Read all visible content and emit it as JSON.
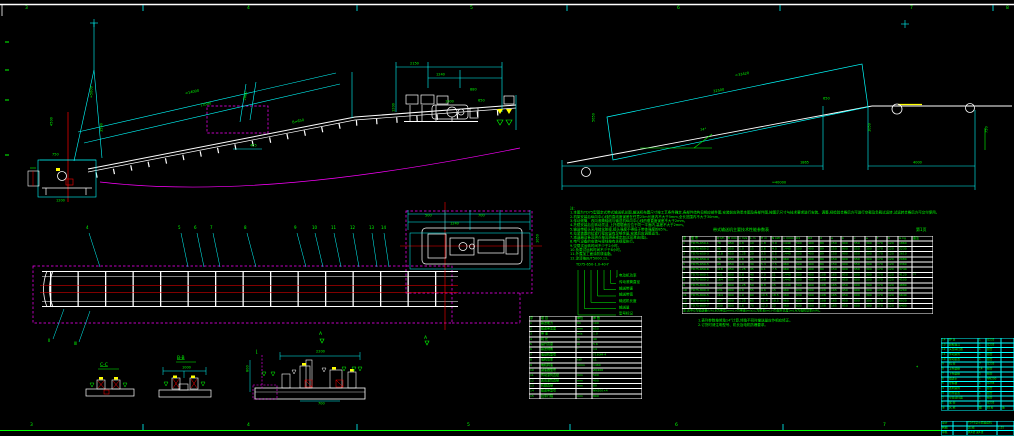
{
  "colors": {
    "cyan": "#00ffff",
    "green": "#00ff00",
    "magenta": "#ff00ff",
    "red": "#ff0000",
    "yellow": "#ffff00",
    "white": "#ffffff",
    "background": "#000000"
  },
  "border": {
    "top_zones": [
      {
        "x": 25,
        "t": "3"
      },
      {
        "x": 247,
        "t": "4"
      },
      {
        "x": 470,
        "t": "5"
      },
      {
        "x": 677,
        "t": "6"
      },
      {
        "x": 910,
        "t": "7"
      },
      {
        "x": 1006,
        "t": "8"
      }
    ],
    "bottom_zones": [
      {
        "x": 30,
        "t": "3"
      },
      {
        "x": 247,
        "t": "4"
      },
      {
        "x": 467,
        "t": "5"
      },
      {
        "x": 675,
        "t": "6"
      },
      {
        "x": 883,
        "t": "7"
      }
    ]
  },
  "notes": {
    "lines": [
      "注:",
      "1.本图为TD75型固定式带式输送机总图,输送机布置尺寸按工艺条件确定,各部件结构见相应部件图,安装前应熟悉本图及各部件图,按图示尺寸与技术要求进行安装、调整,经检验合格后方可进行空载及负载试运转,试运转合格后方可交付使用。",
      "2.机架安装后纵向中心线的直线度误差在任意25m长度内不大于5mm,全长范围内不大于30mm。",
      "3.传动滚筒、改向滚筒轴线与输送机纵向中心线的垂直度误差不大于2mm。",
      "4.托辊安装后应转动灵活,上托辊辊面应位于同一平面内,高差不大于2mm。",
      "5.输送带接头采用硫化胶接,接头强度不得低于带体强度的85%。",
      "6.拉紧装置的拉紧行程应留有足够余量,安装后应调整适当。",
      "7.减速器及各润滑点按润滑表规定加注润滑油(脂)。",
      "8.电气设备的安装与接线按有关规程执行。",
      "9.空载试运转时间不少于2小时。",
      "10.负载试运转时间不少于8小时。",
      "11.外露加工面涂防锈油脂。",
      "12.涂漆按JB/T5000.12。"
    ]
  },
  "type_key": {
    "code": "TD75-650-1.0-40-Y",
    "labels": [
      "电动机功率",
      "传动滚筒直径",
      "输送带速",
      "输送带宽",
      "输送机长度",
      "输送量",
      "型号标记"
    ]
  },
  "annotations": {
    "dims": [
      {
        "x": 185,
        "y": 92,
        "r": -12,
        "t": "≈14000"
      },
      {
        "x": 200,
        "y": 104,
        "r": -12,
        "t": "13500"
      },
      {
        "x": 292,
        "y": 121,
        "r": -12,
        "t": "B=650"
      },
      {
        "x": 90,
        "y": 98,
        "r": -90,
        "t": "≈5000"
      },
      {
        "x": 50,
        "y": 126,
        "r": -90,
        "t": "4500"
      },
      {
        "x": 100,
        "y": 132,
        "r": -90,
        "t": "3500"
      },
      {
        "x": 243,
        "y": 100,
        "r": -78,
        "t": "2860"
      },
      {
        "x": 250,
        "y": 144,
        "r": 0,
        "t": "455"
      },
      {
        "x": 56,
        "y": 199,
        "r": 0,
        "t": "1200"
      },
      {
        "x": 52,
        "y": 153,
        "r": 0,
        "t": "750"
      },
      {
        "x": 410,
        "y": 62,
        "r": 0,
        "t": "2150"
      },
      {
        "x": 436,
        "y": 73,
        "r": 0,
        "t": "1240"
      },
      {
        "x": 470,
        "y": 88,
        "r": 0,
        "t": "880"
      },
      {
        "x": 392,
        "y": 112,
        "r": -90,
        "t": "1200"
      },
      {
        "x": 478,
        "y": 99,
        "r": 0,
        "t": "650"
      },
      {
        "x": 735,
        "y": 74,
        "r": -10,
        "t": "≈33420"
      },
      {
        "x": 713,
        "y": 90,
        "r": -10,
        "t": "32500"
      },
      {
        "x": 592,
        "y": 122,
        "r": -90,
        "t": "5650"
      },
      {
        "x": 868,
        "y": 132,
        "r": -90,
        "t": "1050"
      },
      {
        "x": 800,
        "y": 161,
        "r": 0,
        "t": "1865"
      },
      {
        "x": 913,
        "y": 161,
        "r": 0,
        "t": "4000"
      },
      {
        "x": 772,
        "y": 181,
        "r": 0,
        "t": "≈40000"
      },
      {
        "x": 700,
        "y": 128,
        "r": 0,
        "t": "14°"
      },
      {
        "x": 823,
        "y": 97,
        "r": 0,
        "t": "650"
      },
      {
        "x": 985,
        "y": 133,
        "r": -90,
        "t": "750"
      },
      {
        "x": 425,
        "y": 214,
        "r": 0,
        "t": "500"
      },
      {
        "x": 478,
        "y": 214,
        "r": 0,
        "t": "700"
      },
      {
        "x": 450,
        "y": 222,
        "r": 0,
        "t": "1240"
      },
      {
        "x": 536,
        "y": 243,
        "r": -90,
        "t": "1050"
      },
      {
        "x": 182,
        "y": 366,
        "r": 0,
        "t": "1000"
      },
      {
        "x": 316,
        "y": 350,
        "r": 0,
        "t": "2200"
      },
      {
        "x": 246,
        "y": 372,
        "r": -90,
        "t": "800"
      },
      {
        "x": 318,
        "y": 402,
        "r": 0,
        "t": "700"
      },
      {
        "x": 445,
        "y": 100,
        "r": 0,
        "t": "1000"
      }
    ],
    "labels": [
      {
        "x": 100,
        "y": 363,
        "t": "C-C",
        "u": 1
      },
      {
        "x": 177,
        "y": 356,
        "t": "B-B",
        "u": 1
      },
      {
        "x": 256,
        "y": 350,
        "t": "Ⅰ",
        "u": 1
      },
      {
        "x": 319,
        "y": 332,
        "t": "A",
        "u": 0
      },
      {
        "x": 424,
        "y": 336,
        "t": "A",
        "u": 0
      },
      {
        "x": 916,
        "y": 366,
        "t": "*",
        "u": 0
      }
    ]
  },
  "callouts": {
    "plan_top": [
      {
        "x": 88,
        "dx": 12,
        "t": "4"
      },
      {
        "x": 180,
        "dx": 8,
        "t": "5"
      },
      {
        "x": 196,
        "dx": 8,
        "t": "6"
      },
      {
        "x": 212,
        "dx": 8,
        "t": "7"
      },
      {
        "x": 246,
        "dx": 10,
        "t": "8"
      },
      {
        "x": 296,
        "dx": 10,
        "t": "9"
      },
      {
        "x": 314,
        "dx": 9,
        "t": "10"
      },
      {
        "x": 333,
        "dx": 8,
        "t": "11"
      },
      {
        "x": 352,
        "dx": 7,
        "t": "12"
      },
      {
        "x": 371,
        "dx": 6,
        "t": "13"
      },
      {
        "x": 383,
        "dx": 6,
        "t": "14"
      }
    ],
    "plan_bottom": [
      {
        "x": 50,
        "y": 341,
        "tx": 64,
        "ty": 309,
        "t": "Ⅱ"
      },
      {
        "x": 76,
        "y": 344,
        "tx": 90,
        "ty": 311,
        "t": "Ⅲ"
      }
    ]
  },
  "big_table": {
    "title": "带式输送机主要技术性能参数表",
    "page": "第1页",
    "headers": [
      "序",
      "型  号",
      "Q t/h",
      "B mm",
      "v m/s",
      "L m",
      "H m",
      "N kW",
      "n r/min",
      "D1",
      "D2",
      "d",
      "a",
      "b",
      "c",
      "e",
      "f",
      "h",
      "G kg",
      "备注"
    ],
    "rows": [
      [
        "1",
        "TD75-650-1",
        "78",
        "650",
        "0.8",
        "10",
        "1.8",
        "3.0",
        "1440",
        "500",
        "400",
        "89",
        "150",
        "900",
        "550",
        "300",
        "170",
        "120",
        "1860",
        ""
      ],
      [
        "2",
        "TD75-650-2",
        "98",
        "650",
        "1.0",
        "15",
        "2.6",
        "4.0",
        "1440",
        "500",
        "400",
        "89",
        "150",
        "900",
        "550",
        "300",
        "170",
        "120",
        "2230",
        ""
      ],
      [
        "3",
        "TD75-650-3",
        "118",
        "650",
        "1.25",
        "20",
        "3.5",
        "5.5",
        "1440",
        "500",
        "400",
        "89",
        "150",
        "900",
        "550",
        "300",
        "170",
        "120",
        "2610",
        ""
      ],
      [
        "4",
        "TD75-650-4",
        "78",
        "650",
        "0.8",
        "25",
        "4.4",
        "5.5",
        "960",
        "500",
        "400",
        "89",
        "150",
        "900",
        "550",
        "300",
        "170",
        "120",
        "2980",
        ""
      ],
      [
        "5",
        "TD75-650-5",
        "98",
        "650",
        "1.0",
        "30",
        "5.3",
        "7.5",
        "960",
        "500",
        "400",
        "89",
        "150",
        "900",
        "550",
        "300",
        "170",
        "120",
        "3360",
        ""
      ],
      [
        "6",
        "TD75-650-6",
        "118",
        "650",
        "1.25",
        "35",
        "6.1",
        "7.5",
        "960",
        "500",
        "400",
        "89",
        "150",
        "900",
        "550",
        "300",
        "170",
        "120",
        "3740",
        ""
      ],
      [
        "7",
        "TD75-800-1",
        "131",
        "800",
        "0.8",
        "40",
        "7.0",
        "11",
        "1440",
        "500",
        "400",
        "108",
        "165",
        "950",
        "600",
        "300",
        "170",
        "120",
        "4120",
        "**"
      ],
      [
        "8",
        "TD75-800-2",
        "164",
        "800",
        "1.0",
        "45",
        "7.9",
        "11",
        "1440",
        "500",
        "400",
        "108",
        "165",
        "950",
        "600",
        "300",
        "170",
        "120",
        "4500",
        ""
      ],
      [
        "9",
        "TD75-800-3",
        "197",
        "800",
        "1.25",
        "50",
        "8.8",
        "15",
        "1440",
        "500",
        "400",
        "108",
        "165",
        "950",
        "600",
        "300",
        "170",
        "120",
        "4880",
        ""
      ],
      [
        "10",
        "TD75-800-4",
        "131",
        "800",
        "0.8",
        "55",
        "9.6",
        "15",
        "960",
        "630",
        "500",
        "108",
        "165",
        "950",
        "600",
        "300",
        "170",
        "120",
        "5260",
        ""
      ],
      [
        "11",
        "TD75-800-5",
        "164",
        "800",
        "1.0",
        "60",
        "10.5",
        "18.5",
        "960",
        "630",
        "500",
        "108",
        "165",
        "950",
        "600",
        "300",
        "170",
        "120",
        "5640",
        ""
      ],
      [
        "12",
        "TD75-800-6",
        "197",
        "800",
        "1.25",
        "65",
        "11.4",
        "18.5",
        "960",
        "630",
        "500",
        "108",
        "165",
        "950",
        "600",
        "300",
        "170",
        "120",
        "6020",
        ""
      ],
      [
        "13",
        "TD75-800-7",
        "230",
        "800",
        "1.6",
        "70",
        "12.3",
        "22",
        "960",
        "630",
        "500",
        "108",
        "165",
        "950",
        "600",
        "300",
        "170",
        "120",
        "6400",
        ""
      ]
    ],
    "footnote": "注:表中Q为输送量(t/h),B为带宽(mm),v为带速(m/s),L为机长(m),H为提升高度(m),N为电机功率(kW)。",
    "under_notes": [
      "1.表列参数按倾角14°计算,倾角不同时输送量应作相应修正。",
      "2.订货时请注明型号、机长及电机防爆要求。"
    ]
  },
  "spec_table": {
    "headers": [
      "序",
      "项  目",
      "单位",
      "参  数"
    ],
    "rows": [
      [
        "1",
        "输送能力",
        "t/h",
        "100"
      ],
      [
        "2",
        "输送带宽度",
        "mm",
        "650"
      ],
      [
        "3",
        "带  速",
        "m/s",
        "1.0"
      ],
      [
        "4",
        "机  长",
        "m",
        "40"
      ],
      [
        "5",
        "提升高度",
        "m",
        "5.6"
      ],
      [
        "6",
        "输送倾角",
        "°",
        "14"
      ],
      [
        "7",
        "电动机型号",
        "",
        "Y160M-4"
      ],
      [
        "8",
        "电机功率",
        "kW",
        "11"
      ],
      [
        "9",
        "电机转速",
        "r/min",
        "1460"
      ],
      [
        "10",
        "减速器型号",
        "",
        "ZQ400"
      ],
      [
        "11",
        "传动滚筒直径",
        "mm",
        "500"
      ],
      [
        "12",
        "改向滚筒直径",
        "mm",
        "400"
      ],
      [
        "13",
        "托辊直径",
        "mm",
        "89"
      ],
      [
        "14",
        "输送带型号",
        "",
        "NN200×4"
      ],
      [
        "15",
        "拉紧行程",
        "mm",
        "800"
      ]
    ]
  },
  "parts_list": {
    "rows": [
      [
        "14",
        "护  罩",
        "1",
        "Q235",
        ""
      ],
      [
        "13",
        "卸料漏斗",
        "1",
        "Q235",
        ""
      ],
      [
        "12",
        "头部清扫器",
        "1",
        "组合",
        ""
      ],
      [
        "11",
        "传动滚筒",
        "1",
        "组合",
        ""
      ],
      [
        "10",
        "驱动装置",
        "1",
        "组合",
        ""
      ],
      [
        "9",
        "机  架",
        "7",
        "Q235",
        ""
      ],
      [
        "8",
        "上托辊组",
        "14",
        "组合",
        ""
      ],
      [
        "7",
        "下托辊组",
        "5",
        "组合",
        ""
      ],
      [
        "6",
        "输送带",
        "1",
        "NN200",
        ""
      ],
      [
        "5",
        "导料槽",
        "1",
        "Q235",
        ""
      ],
      [
        "4",
        "改向滚筒",
        "1",
        "组合",
        ""
      ],
      [
        "3",
        "拉紧装置",
        "1",
        "组合",
        ""
      ],
      [
        "2",
        "空段清扫器",
        "1",
        "组合",
        ""
      ],
      [
        "1",
        "尾  架",
        "1",
        "Q235",
        ""
      ]
    ],
    "headers": [
      "序",
      "名  称",
      "数",
      "材 料",
      "备"
    ]
  },
  "title_block": {
    "rows": [
      [
        "设计",
        "",
        "TD75型带式输送机",
        ""
      ],
      [
        "制图",
        "",
        "总  图",
        "1:25"
      ],
      [
        "审核",
        "",
        "共1张 第1张",
        ""
      ]
    ]
  }
}
